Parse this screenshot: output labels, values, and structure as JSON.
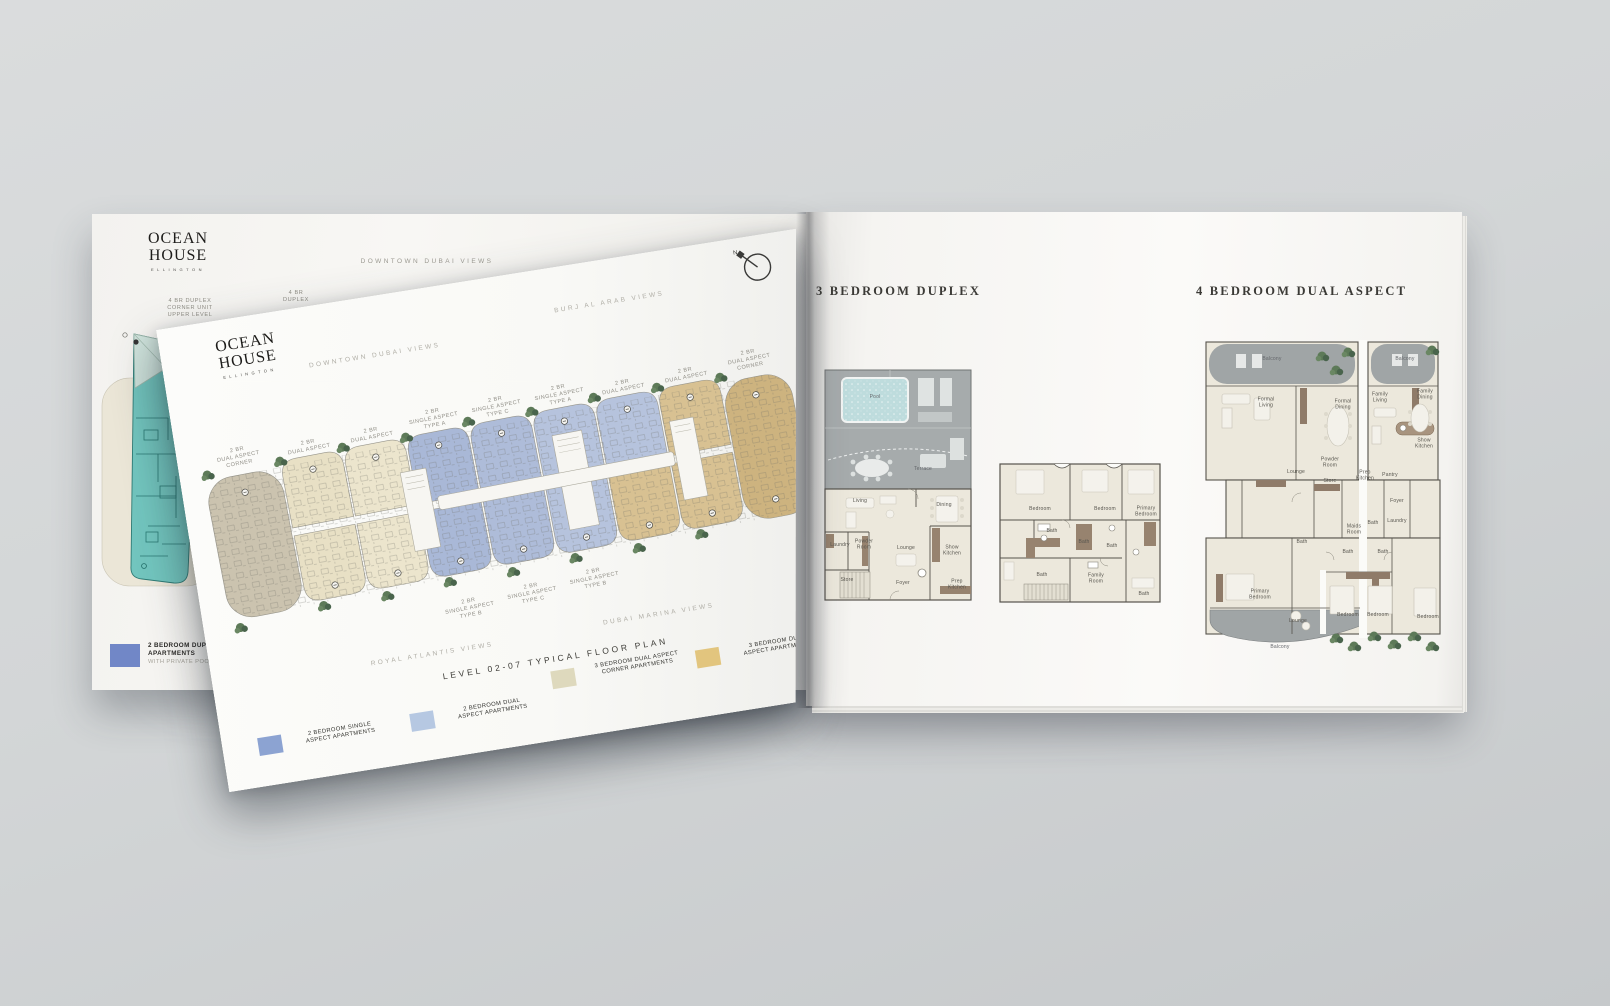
{
  "brand": {
    "name": "OCEAN HOUSE",
    "sub": "ELLINGTON"
  },
  "left_page": {
    "view_label": "DOWNTOWN DUBAI VIEWS",
    "unit_label_corner": "4 BR DUPLEX\nCORNER UNIT\nUPPER LEVEL",
    "unit_label_duplex": "4 BR\nDUPLEX",
    "legend_item": {
      "swatch_color": "#7187c7",
      "label_main": "2 BEDROOM DUPLEX\nAPARTMENTS",
      "label_sub": "WITH PRIVATE POOL"
    }
  },
  "overlay_page": {
    "views": {
      "top_left": "DOWNTOWN DUBAI VIEWS",
      "top_right": "BURJ AL ARAB VIEWS",
      "bottom_left": "ROYAL ATLANTIS VIEWS",
      "bottom_right": "DUBAI MARINA VIEWS"
    },
    "compass_label": "N",
    "title": "LEVEL 02-07 TYPICAL FLOOR PLAN",
    "top_unit_labels": [
      "2 BR\nDUAL ASPECT\nCORNER",
      "2 BR\nDUAL ASPECT",
      "2 BR\nDUAL ASPECT",
      "2 BR\nSINGLE ASPECT\nTYPE A",
      "2 BR\nSINGLE ASPECT\nTYPE C",
      "2 BR\nSINGLE ASPECT\nTYPE A",
      "2 BR\nDUAL ASPECT",
      "2 BR\nDUAL ASPECT",
      "2 BR\nDUAL ASPECT\nCORNER"
    ],
    "bottom_unit_labels": [
      "2 BR\nSINGLE ASPECT\nTYPE B",
      "2 BR\nSINGLE ASPECT\nTYPE C",
      "2 BR\nSINGLE ASPECT\nTYPE B"
    ],
    "legend": [
      {
        "label": "2 BEDROOM SINGLE\nASPECT APARTMENTS",
        "color": "#8ca3d2"
      },
      {
        "label": "2 BEDROOM DUAL\nASPECT APARTMENTS",
        "color": "#b6c8e2"
      },
      {
        "label": "3 BEDROOM DUAL ASPECT\nCORNER APARTMENTS",
        "color": "#ded9bd"
      },
      {
        "label": "3 BEDROOM DUAL\nASPECT APARTMENTS",
        "color": "#e2c57e"
      }
    ]
  },
  "right_page": {
    "duplex": {
      "title": "3 BEDROOM DUPLEX",
      "lower_rooms": [
        "Pool",
        "Terrace",
        "Living",
        "Dining",
        "Laundry",
        "Powder\nRoom",
        "Lounge",
        "Show\nKitchen",
        "Store",
        "Foyer",
        "Prep\nKitchen"
      ],
      "upper_rooms": [
        "Bedroom",
        "Bath",
        "Bedroom",
        "Bath",
        "Primary\nBedroom",
        "Bath",
        "Bath",
        "Family\nRoom",
        "Bath"
      ]
    },
    "four_bed": {
      "title": "4 BEDROOM DUAL ASPECT",
      "rooms": [
        "Balcony",
        "Balcony",
        "Formal\nLiving",
        "Formal\nDining",
        "Family\nLiving",
        "Family\nDining",
        "Show\nKitchen",
        "Lounge",
        "Powder\nRoom",
        "Store",
        "Prep\nKitchen",
        "Pantry",
        "Foyer",
        "Bath",
        "Maids\nRoom",
        "Bath",
        "Laundry",
        "Bath",
        "Bath",
        "Primary\nBedroom",
        "Lounge",
        "Bedroom",
        "Bedroom",
        "Bedroom",
        "Balcony"
      ]
    }
  },
  "colors": {
    "background": "#d3d6d7",
    "page": "#f9f8f5",
    "teal_unit": "#72c5be",
    "unit_blue": "#a9b8d7",
    "unit_blue_light": "#b6c3dd",
    "unit_beige": "#e8e0c5",
    "unit_khaki": "#cbc3af",
    "unit_tan": "#d8c192",
    "unit_tan_dark": "#cdb37f",
    "terrace_gray": "#a6abac",
    "interior_floor": "#ece8dc",
    "pool_blue": "#bedcdd",
    "greenery": "#5d7a58",
    "wall": "#56534c"
  }
}
